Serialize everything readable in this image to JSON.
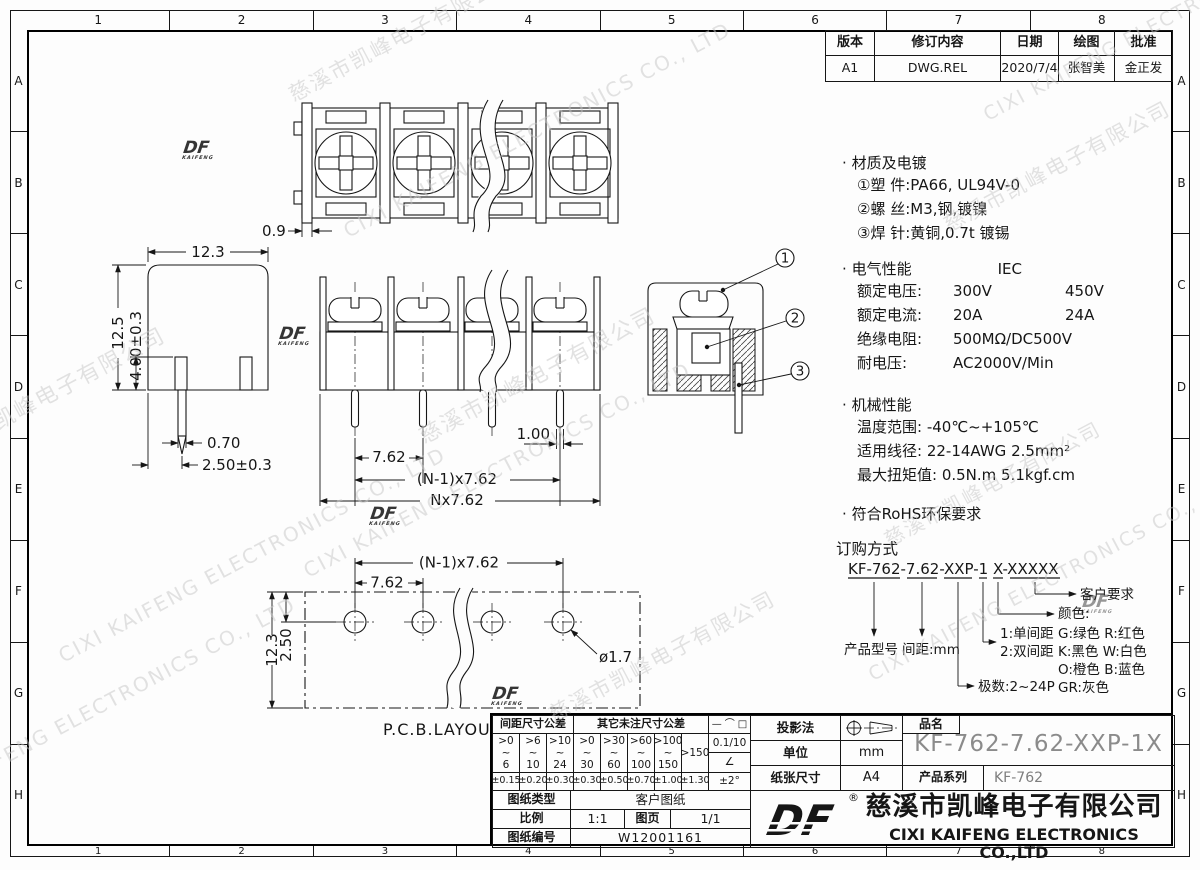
{
  "sheet": {
    "grid_cols": [
      "1",
      "2",
      "3",
      "4",
      "5",
      "6",
      "7",
      "8"
    ],
    "grid_rows": [
      "A",
      "B",
      "C",
      "D",
      "E",
      "F",
      "G",
      "H"
    ]
  },
  "revision": {
    "h_version": "版本",
    "h_content": "修订内容",
    "h_date": "日期",
    "h_draw": "绘图",
    "h_approve": "批准",
    "version": "A1",
    "content": "DWG.REL",
    "date": "2020/7/4",
    "draw": "张智美",
    "approve": "金正发"
  },
  "notes": {
    "bullet": "·",
    "material_title": "材质及电镀",
    "material_items": [
      "①塑 件:PA66, UL94V-0",
      "②螺 丝:M3,钢,镀镍",
      "③焊 针:黄铜,0.7t 镀锡"
    ],
    "electrical_title": "电气性能",
    "electrical_std": "IEC",
    "electrical_rows": [
      {
        "label": "额定电压:",
        "v1": "300V",
        "v2": "450V"
      },
      {
        "label": "额定电流:",
        "v1": "20A",
        "v2": "24A"
      },
      {
        "label": "绝缘电阻:",
        "v1": "500MΩ/DC500V",
        "v2": ""
      },
      {
        "label": "耐电压:",
        "v1": "AC2000V/Min",
        "v2": ""
      }
    ],
    "mechanical_title": "机械性能",
    "mechanical_items": [
      "温度范围: -40℃~+105℃",
      "适用线径: 22-14AWG 2.5mm²",
      "最大扭矩值: 0.5N.m 5.1kgf.cm"
    ],
    "rohs": "符合RoHS环保要求"
  },
  "ordering": {
    "title": "订购方式",
    "code": "KF-762-7.62-XXP-1 X-XXXXX",
    "product_model": "产品型号",
    "pitch": "间距:mm",
    "poles": "极数:2~24P",
    "spacing1": "1:单间距",
    "spacing2": "2:双间距",
    "color_title": "颜色:",
    "color_rows": [
      "G:绿色  R:红色",
      "K:黑色  W:白色",
      "O:橙色  B:蓝色",
      "GR:灰色"
    ],
    "customer": "客户要求"
  },
  "dims": {
    "top_view": {
      "wall": "0.9"
    },
    "side_view": {
      "width": "12.3",
      "height": "12.5",
      "slot": "4.00±0.3",
      "pin_w": "0.70",
      "pin_off": "2.50±0.3"
    },
    "front_view": {
      "pin": "1.00",
      "pitch": "7.62",
      "pitch_n1": "(N-1)x7.62",
      "pitch_n": "Nx7.62"
    },
    "section": {
      "b1": "1",
      "b2": "2",
      "b3": "3"
    },
    "pcb": {
      "label": "P.C.B.LAYOUT",
      "pitch_n1": "(N-1)x7.62",
      "pitch": "7.62",
      "height": "12.3",
      "offset": "2.50",
      "hole": "ø1.7"
    }
  },
  "titleblock": {
    "pitch_tol_header": "间距尺寸公差",
    "other_tol_header": "其它未注尺寸公差",
    "ranges": [
      ">0\n~\n6",
      ">6\n~\n10",
      ">10\n~\n24",
      ">0\n~\n30",
      ">30\n~\n60",
      ">60\n~\n100",
      ">100\n~\n150",
      ">150"
    ],
    "values": [
      "±0.15",
      "±0.20",
      "±0.30",
      "±0.30",
      "±0.50",
      "±0.70",
      "±1.00",
      "±1.30"
    ],
    "geo_symbols": [
      "—",
      "⌒",
      "□"
    ],
    "geo_value": "0.1/10",
    "angle_symbol": "∠",
    "angle_value": "±2°",
    "projection_label": "投影法",
    "unit_label": "单位",
    "unit_value": "mm",
    "paper_label": "纸张尺寸",
    "paper_value": "A4",
    "name_label": "品名",
    "name_value": "KF-762-7.62-XXP-1X",
    "series_label": "产品系列",
    "series_value": "KF-762",
    "doc_type_label": "图纸类型",
    "doc_type_value": "客户图纸",
    "scale_label": "比例",
    "scale_value": "1:1",
    "page_label": "图页",
    "page_value": "1/1",
    "number_label": "图纸编号",
    "number_value": "W12001161"
  },
  "company": {
    "logo": "DF",
    "reg": "®",
    "cn": "慈溪市凯峰电子有限公司",
    "en": "CIXI KAIFENG ELECTRONICS CO.,LTD"
  },
  "watermark": {
    "cn": "慈溪市凯峰电子有限公司",
    "en": "CIXI KAIFENG ELECTRONICS CO., LTD",
    "logo": "DF"
  }
}
